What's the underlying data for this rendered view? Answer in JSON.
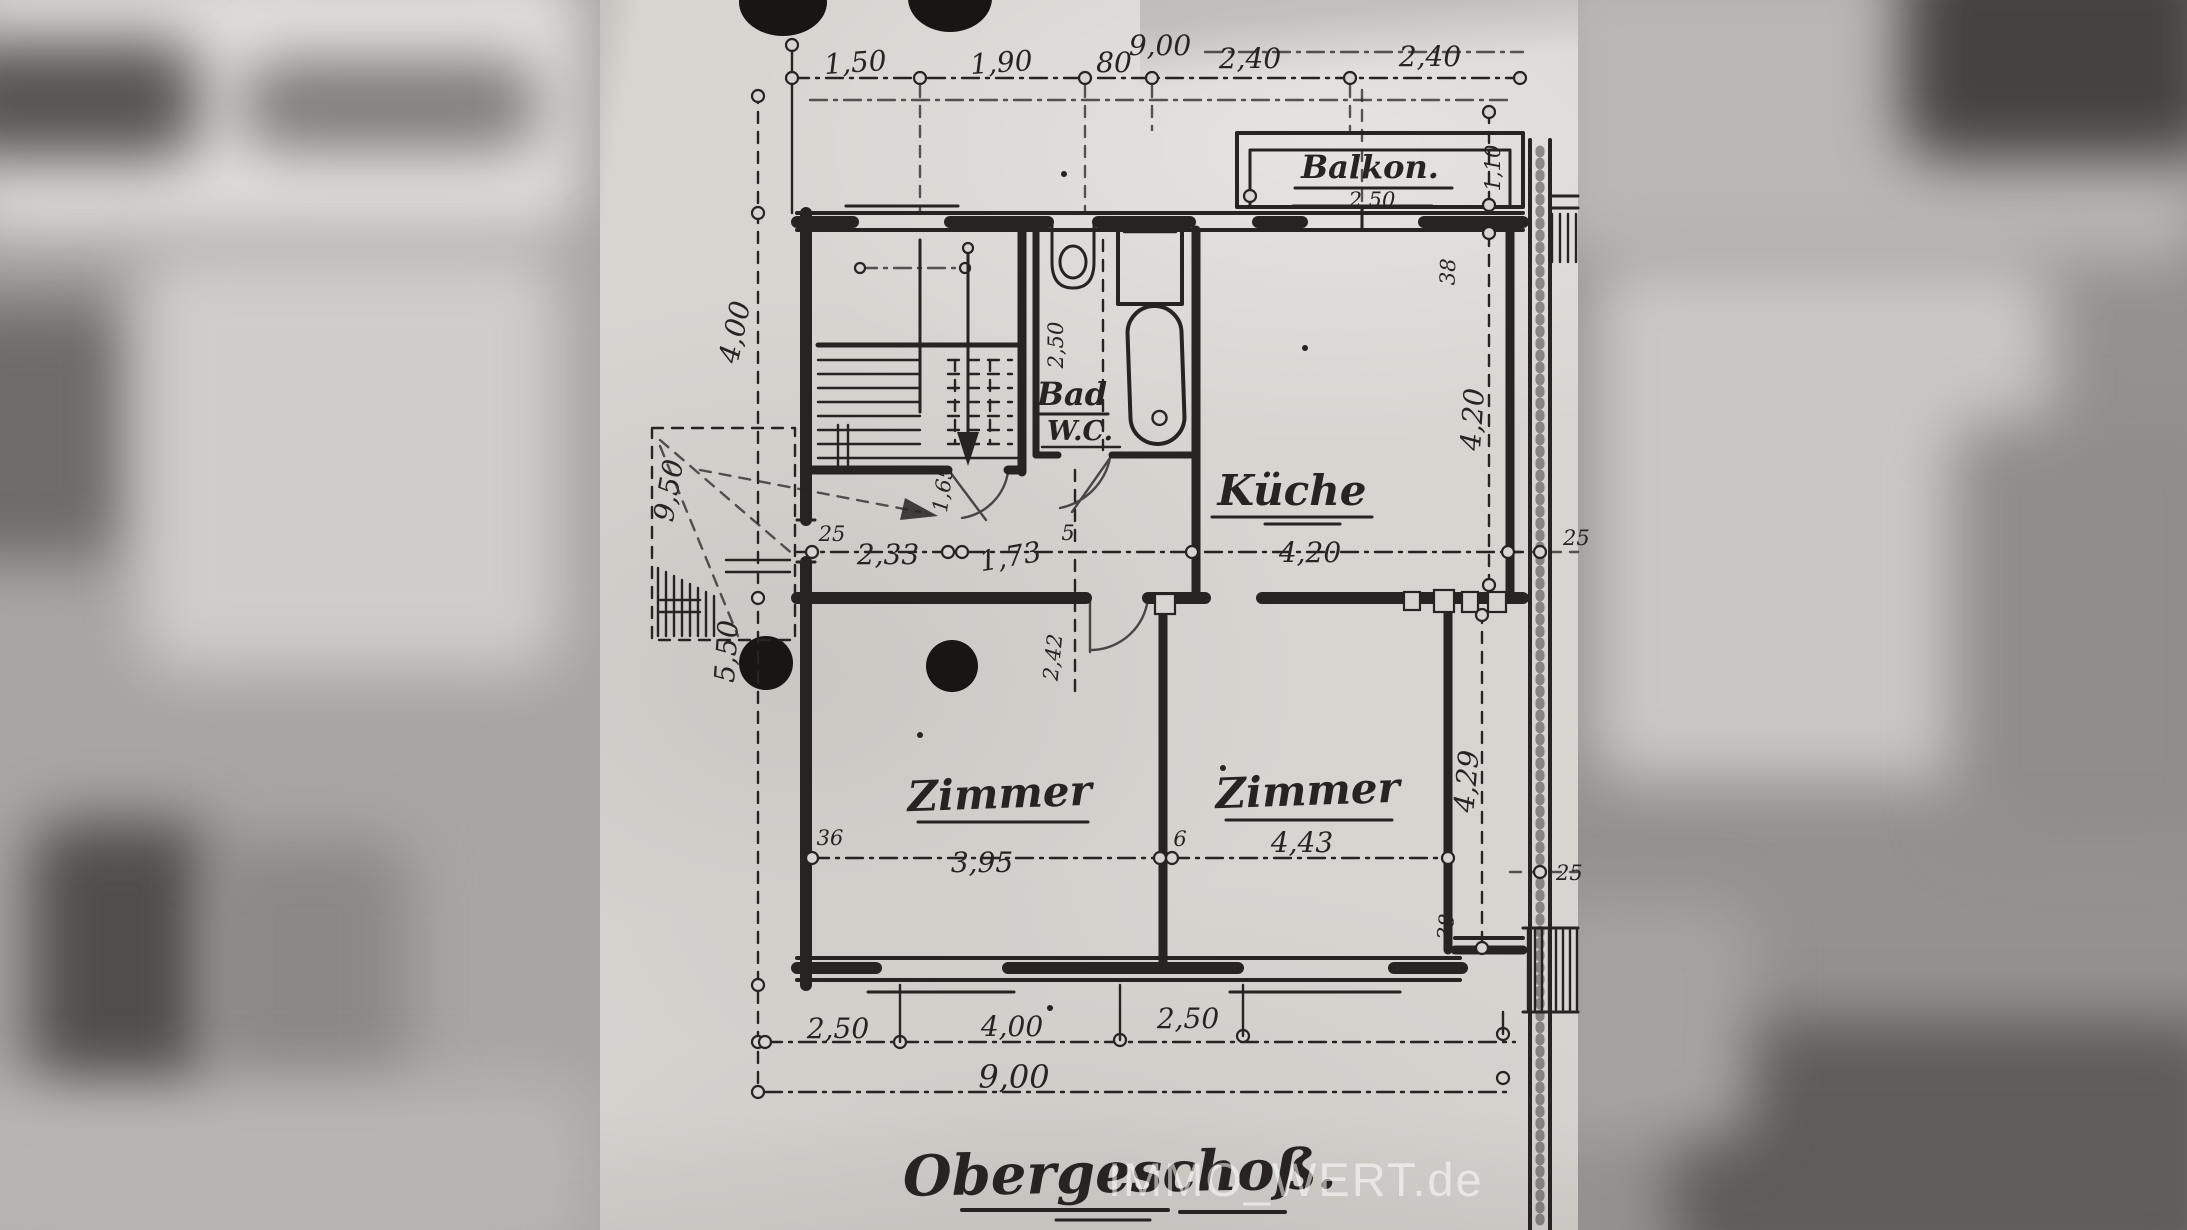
{
  "title": "Obergeschoß.",
  "watermark": "IMMO_WERT.de",
  "rooms": {
    "balkon": "Balkon.",
    "bad": "Bad",
    "wc": "W.C.",
    "kueche": "Küche",
    "zimmer_left": "Zimmer",
    "zimmer_right": "Zimmer"
  },
  "dims": {
    "top_total": "9,00",
    "top_1": "1,50",
    "top_2": "1,90",
    "top_3": "80",
    "top_4": "2,40",
    "top_5": "2,40",
    "balkon_w": "2,50",
    "balkon_d": "1,10",
    "left_upper": "4,00",
    "left_total": "9,50",
    "left_lower": "5,50",
    "wall_25": "25",
    "hall_233": "2,33",
    "hall_165": "1,65",
    "hall_173": "1,73",
    "door_5": "5",
    "mid_420": "4,20",
    "bath_250": "2,50",
    "below_242": "2,42",
    "right_38_top": "38",
    "kitchen_420": "4,20",
    "right_25_top": "25",
    "right_429": "4,29",
    "right_38_bottom": "38",
    "right_25_bottom": "25",
    "z1_36": "36",
    "z1_width": "3,95",
    "z2_6": "6",
    "z2_width": "4,43",
    "bottom_1": "2,50",
    "bottom_2": "4,00",
    "bottom_3": "2,50",
    "bottom_total": "9,00"
  }
}
